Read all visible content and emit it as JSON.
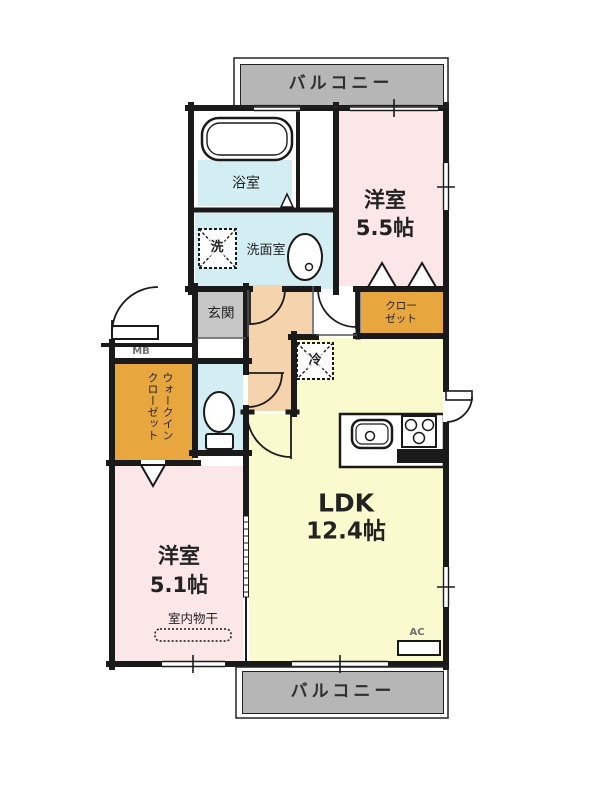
{
  "balcony_top": {
    "label": "バルコニー"
  },
  "balcony_bottom": {
    "label": "バルコニー"
  },
  "rooms": {
    "bath": {
      "label": "浴室"
    },
    "washroom": {
      "label": "洗面室"
    },
    "bedroom1": {
      "name": "洋室",
      "size": "5.5帖"
    },
    "closet": {
      "label": "クローゼット"
    },
    "entrance": {
      "label": "玄関"
    },
    "wic": {
      "label": "ウォークインクローゼット"
    },
    "bedroom2": {
      "name": "洋室",
      "size": "5.1帖"
    },
    "ldk": {
      "name": "LDK",
      "size": "12.4帖"
    }
  },
  "fixtures": {
    "washer": {
      "label": "洗"
    },
    "fridge": {
      "label": "冷"
    },
    "meter_box": {
      "label": "MB"
    },
    "air_con": {
      "label": "AC"
    },
    "indoor_drying": {
      "label": "室内物干"
    }
  },
  "colors": {
    "balcony": "#b6b6b6",
    "western_room": "#fbe7e7",
    "ldk": "#fafacF",
    "hall": "#f4d3ad",
    "wet_area": "#d3eef2",
    "closet": "#e7a63e",
    "entrance": "#c6c6c6",
    "wall": "#1a1a1a"
  }
}
